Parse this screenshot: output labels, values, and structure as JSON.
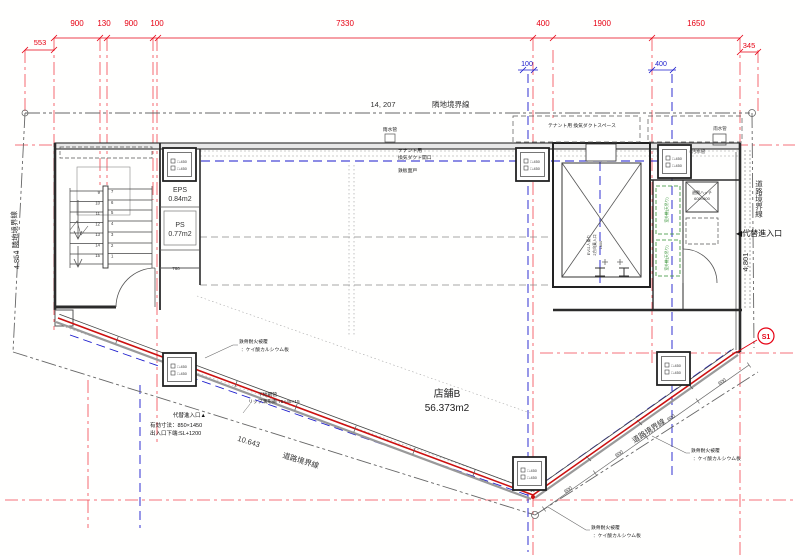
{
  "dims": {
    "top": [
      "900",
      "130",
      "900",
      "100",
      "7330",
      "400",
      "1900",
      "1650"
    ],
    "left": "553",
    "right": "345",
    "blue_a": "100",
    "blue_b": "400",
    "d600": "600",
    "d760": "760"
  },
  "boundary": {
    "top_length": "14, 207",
    "top_label": "隣地境界線",
    "left_label": "4.854  隣地境界線",
    "bottom_length": "10.643",
    "bottom_label": "道路境界線",
    "right_diag_label": "道路境界線",
    "right_vert_label": "道路境界線",
    "right_length": "4,801"
  },
  "markers": {
    "s1": "S1",
    "alt_entry_right": "◀代替進入口"
  },
  "rooms": {
    "shop": "店舗B",
    "shop_area": "56.373m2",
    "eps": "EPS",
    "eps_area": "0.84m2",
    "ps": "PS",
    "ps_area": "0.77m2",
    "ev_line1": "EV11人乗り",
    "ev_line2": "2方向乗入口",
    "ev_line3": "1800",
    "hatch_line1": "避難ハッチ",
    "hatch_line2": "600×600",
    "outdoor_unit": "室外機(天吊り)"
  },
  "notes": {
    "tenant_space": "テナント用 換気ダクトスペース",
    "tenant1": "テナント用",
    "tenant2": "換気ダクト開口",
    "tenant3": "鉄板面戸",
    "rain_pipe": "雨水管",
    "rain_pipe2": "雨水管",
    "sewer_pipe": "○汚水管",
    "fire1": "鉄骨耐火被覆",
    "fire2": "：ケイ酸カルシウム板",
    "base1": "下地鋼管",
    "base2": "リップ溝形鋼 75×45×15",
    "entry1": "代替進入口▲",
    "entry2": "有効寸法：850×1450",
    "entry3": "出入口下端:SL+1200",
    "col_label": "□-450"
  },
  "stairs": {
    "left": [
      "9",
      "10",
      "11",
      "12",
      "13",
      "14",
      "15"
    ],
    "right": [
      "7",
      "6",
      "5",
      "4",
      "3",
      "2",
      "1"
    ]
  },
  "colors": {
    "red": "#e60012",
    "blue": "#1a1acc",
    "green": "#2f8f2f",
    "wall": "#2b2b2b",
    "boundary_gray": "#666666"
  }
}
